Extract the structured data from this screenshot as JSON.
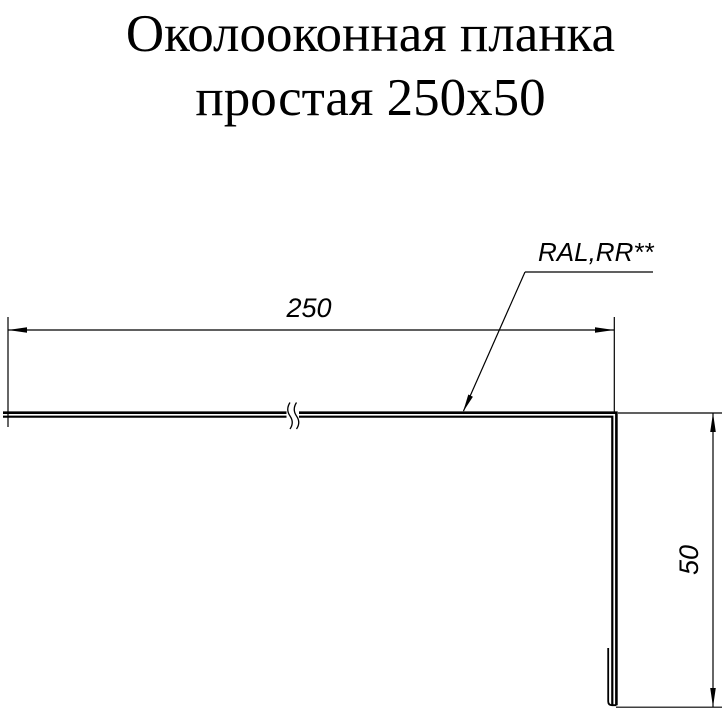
{
  "title": {
    "line1": "Околооконная планка",
    "line2": "простая 250x50"
  },
  "drawing": {
    "width_dimension": "250",
    "height_dimension": "50",
    "coating_label": "RAL,RR**"
  },
  "colors": {
    "ink": "#000000",
    "background": "#ffffff"
  }
}
